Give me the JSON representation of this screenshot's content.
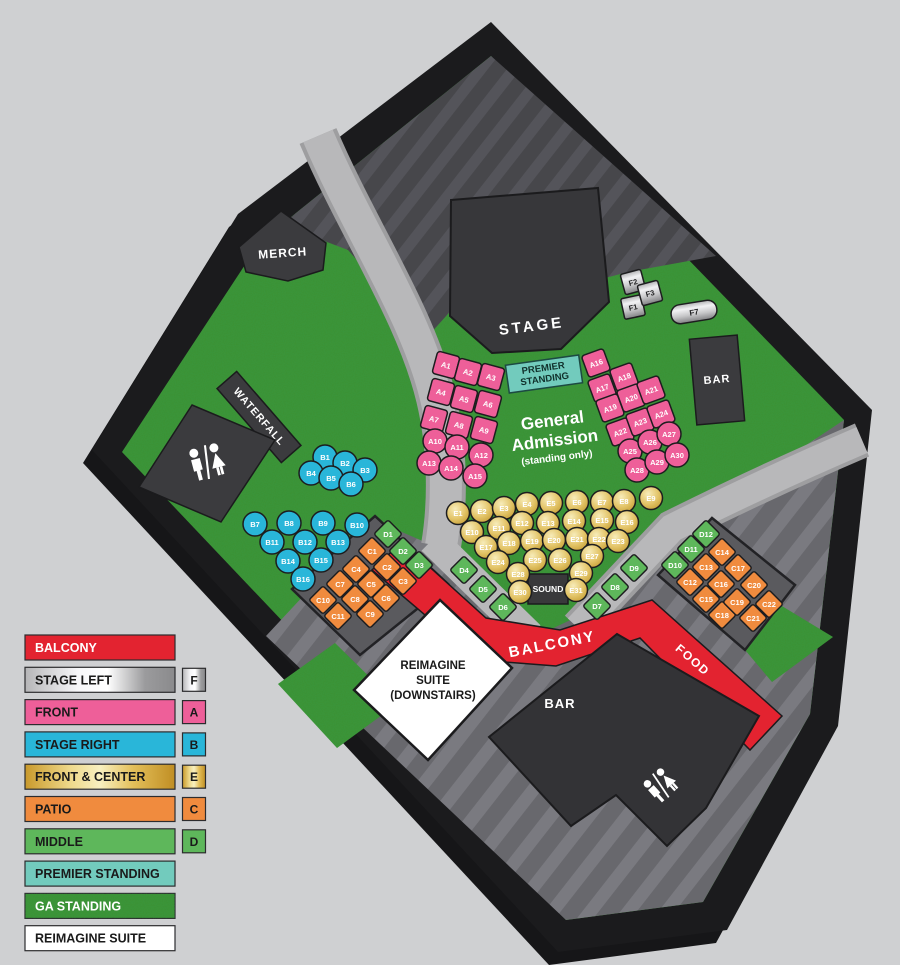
{
  "areas": {
    "stage": "STAGE",
    "merch": "MERCH",
    "waterfall": "WATERFALL",
    "premier1": "PREMIER",
    "premier2": "STANDING",
    "ga1": "General",
    "ga2": "Admission",
    "ga3": "(standing only)",
    "sound": "SOUND",
    "balcony": "BALCONY",
    "food": "FOOD",
    "bar_top": "BAR",
    "bar_bottom": "BAR",
    "suite1": "REIMAGINE",
    "suite2": "SUITE",
    "suite3": "(DOWNSTAIRS)"
  },
  "seats": {
    "a": [
      "A1",
      "A2",
      "A3",
      "A4",
      "A5",
      "A6",
      "A7",
      "A8",
      "A9",
      "A10",
      "A11",
      "A12",
      "A13",
      "A14",
      "A15",
      "A16",
      "A17",
      "A18",
      "A19",
      "A20",
      "A21",
      "A22",
      "A23",
      "A24",
      "A25",
      "A26",
      "A27",
      "A28",
      "A29",
      "A30"
    ],
    "b": [
      "B1",
      "B2",
      "B3",
      "B4",
      "B5",
      "B6",
      "B7",
      "B8",
      "B9",
      "B10",
      "B11",
      "B12",
      "B13",
      "B14",
      "B15",
      "B16"
    ],
    "c": [
      "C1",
      "C2",
      "C3",
      "C4",
      "C5",
      "C6",
      "C7",
      "C8",
      "C9",
      "C10",
      "C11",
      "C12",
      "C13",
      "C14",
      "C15",
      "C16",
      "C17",
      "C18",
      "C19",
      "C20",
      "C21",
      "C22"
    ],
    "d": [
      "D1",
      "D2",
      "D3",
      "D4",
      "D5",
      "D6",
      "D7",
      "D8",
      "D9",
      "D10",
      "D11",
      "D12"
    ],
    "e": [
      "E1",
      "E2",
      "E3",
      "E4",
      "E5",
      "E6",
      "E7",
      "E8",
      "E9",
      "E10",
      "E11",
      "E12",
      "E13",
      "E14",
      "E15",
      "E16",
      "E17",
      "E18",
      "E19",
      "E20",
      "E21",
      "E22",
      "E23",
      "E24",
      "E25",
      "E26",
      "E27",
      "E28",
      "E29",
      "E30",
      "E31"
    ],
    "f": [
      "F1",
      "F2",
      "F3",
      "F7"
    ]
  },
  "legend": {
    "items": [
      {
        "label": "BALCONY",
        "color": "#e32330",
        "text_color": "#ffffff"
      },
      {
        "label": "STAGE LEFT",
        "letter": "F",
        "style": "silver"
      },
      {
        "label": "FRONT",
        "letter": "A",
        "color": "#ee5f99"
      },
      {
        "label": "STAGE RIGHT",
        "letter": "B",
        "color": "#29b6d9"
      },
      {
        "label": "FRONT & CENTER",
        "letter": "E",
        "style": "gold"
      },
      {
        "label": "PATIO",
        "letter": "C",
        "color": "#f08b3e"
      },
      {
        "label": "MIDDLE",
        "letter": "D",
        "color": "#5eb75b"
      },
      {
        "label": "PREMIER STANDING",
        "color": "#72cbbd"
      },
      {
        "label": "GA STANDING",
        "style": "grass",
        "text_color": "#ffffff"
      },
      {
        "label": "REIMAGINE SUITE",
        "color": "#ffffff"
      }
    ]
  },
  "colors": {
    "front_pink": "#ee5f99",
    "stage_right_cyan": "#29b6d9",
    "patio_orange": "#f08b3e",
    "middle_green": "#5eb75b",
    "balcony_red": "#e32330",
    "premier_teal": "#72cbbd",
    "grass_green": "#3c9132"
  }
}
